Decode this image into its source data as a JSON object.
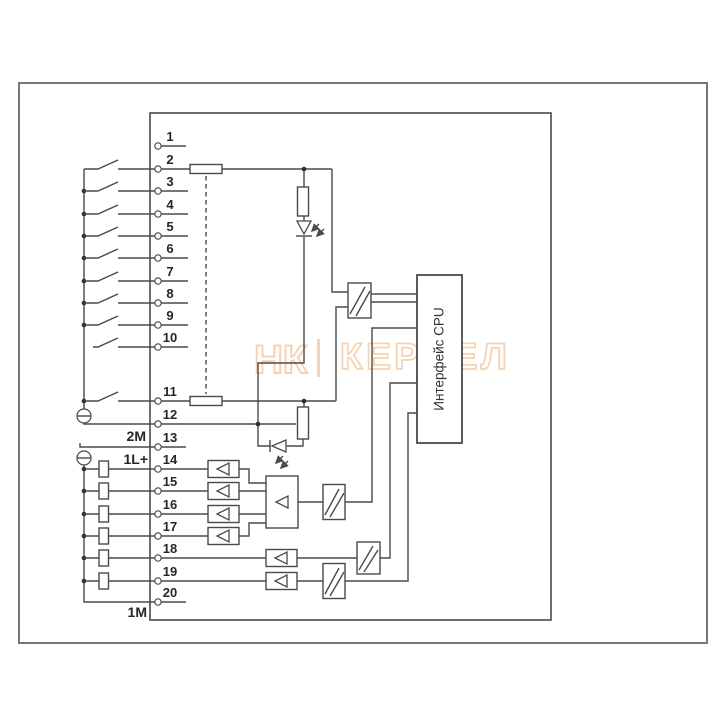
{
  "terminal_numbers": [
    "1",
    "2",
    "3",
    "4",
    "5",
    "6",
    "7",
    "8",
    "9",
    "10",
    "11",
    "12",
    "13",
    "14",
    "15",
    "16",
    "17",
    "18",
    "19",
    "20"
  ],
  "power_labels": {
    "input_common": "2M",
    "output_supply": "1L+",
    "output_common": "1M"
  },
  "module": {
    "cpu_interface_label": "Интерфейс CPU"
  },
  "watermark": {
    "monogram": "НК",
    "text": "КЕРНЕЛ"
  },
  "colors": {
    "line": "#4a4a4a",
    "text": "#262626",
    "watermark": "#f0a763",
    "background": "#ffffff"
  }
}
